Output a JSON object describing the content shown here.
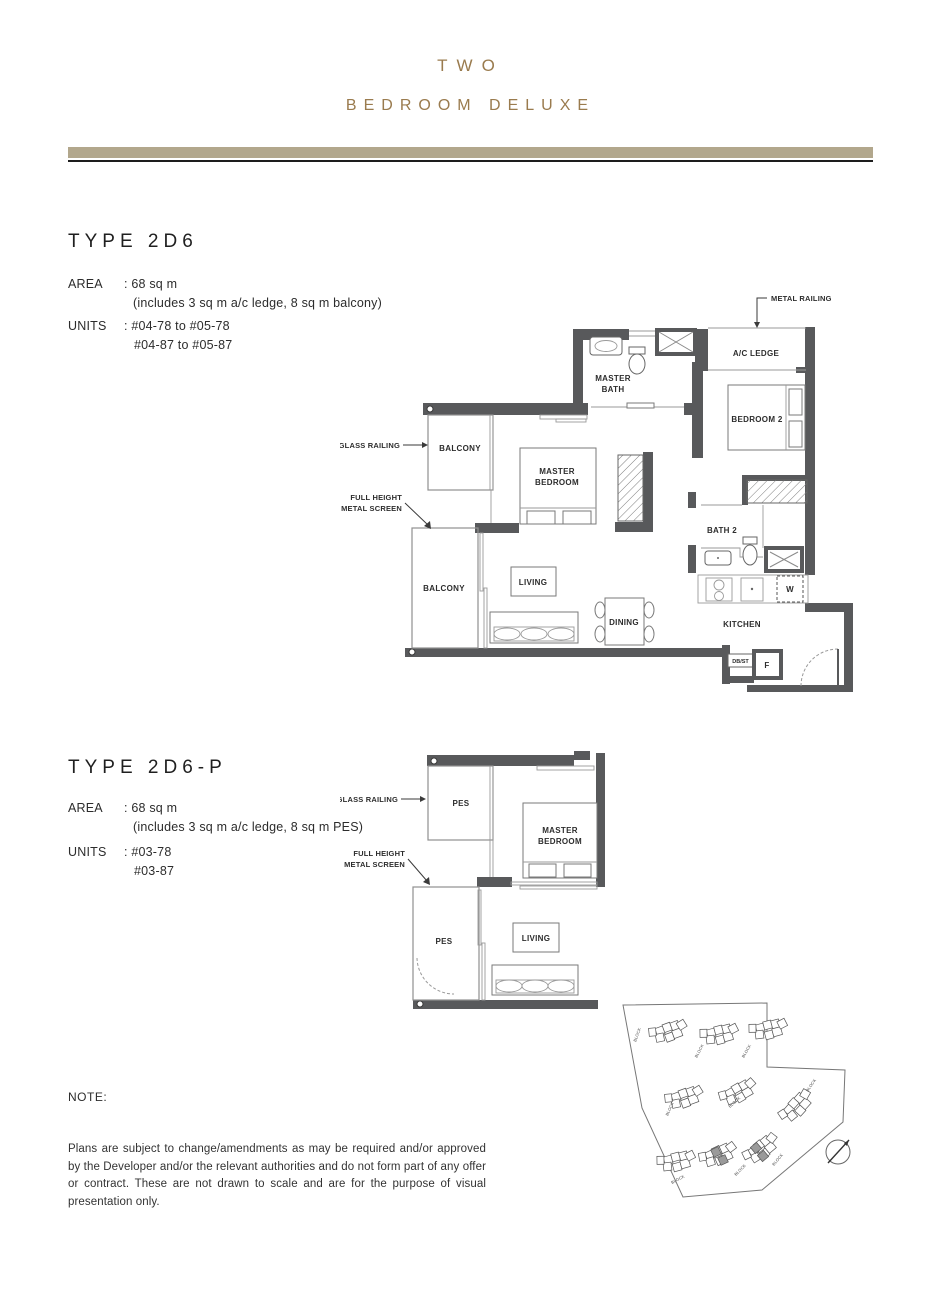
{
  "header": {
    "title_line1": "TWO",
    "title_line2": "BEDROOM DELUXE",
    "accent_color": "#9a7b4e",
    "bar_color": "#b2a78c"
  },
  "type_2d6": {
    "heading": "TYPE 2D6",
    "area_label": "AREA",
    "area_value": ": 68 sq m",
    "area_note": "(includes 3 sq m a/c ledge, 8 sq m balcony)",
    "units_label": "UNITS",
    "units_line1": ": #04-78 to #05-78",
    "units_line2": "#04-87 to #05-87",
    "callouts": {
      "metal_railing": "METAL RAILING",
      "glass_railing": "GLASS RAILING",
      "full_height_line1": "FULL HEIGHT",
      "full_height_line2": "METAL SCREEN"
    },
    "rooms": {
      "master_bath_line1": "MASTER",
      "master_bath_line2": "BATH",
      "ac_ledge": "A/C LEDGE",
      "bedroom2": "BEDROOM 2",
      "balcony_upper": "BALCONY",
      "master_bedroom_line1": "MASTER",
      "master_bedroom_line2": "BEDROOM",
      "balcony_lower": "BALCONY",
      "living": "LIVING",
      "dining": "DINING",
      "bath2": "BATH 2",
      "kitchen": "KITCHEN",
      "washer": "W",
      "dbst": "DB/ST",
      "fridge": "F"
    }
  },
  "type_2d6p": {
    "heading": "TYPE 2D6-P",
    "area_label": "AREA",
    "area_value": ": 68 sq m",
    "area_note": "(includes 3 sq m a/c ledge, 8 sq m PES)",
    "units_label": "UNITS",
    "units_line1": ": #03-78",
    "units_line2": "#03-87",
    "callouts": {
      "glass_railing": "GLASS RAILING",
      "full_height_line1": "FULL HEIGHT",
      "full_height_line2": "METAL SCREEN"
    },
    "rooms": {
      "pes_upper": "PES",
      "master_bedroom_line1": "MASTER",
      "master_bedroom_line2": "BEDROOM",
      "pes_lower": "PES",
      "living": "LIVING"
    }
  },
  "site_plan": {
    "block_label": "BLOCK"
  },
  "note": {
    "label": "NOTE:",
    "disclaimer": "Plans are subject to change/amendments as may be required and/or approved by the Developer and/or the relevant authorities and do not form part of any offer or contract. These are not drawn to scale and are for the purpose of visual presentation only."
  }
}
